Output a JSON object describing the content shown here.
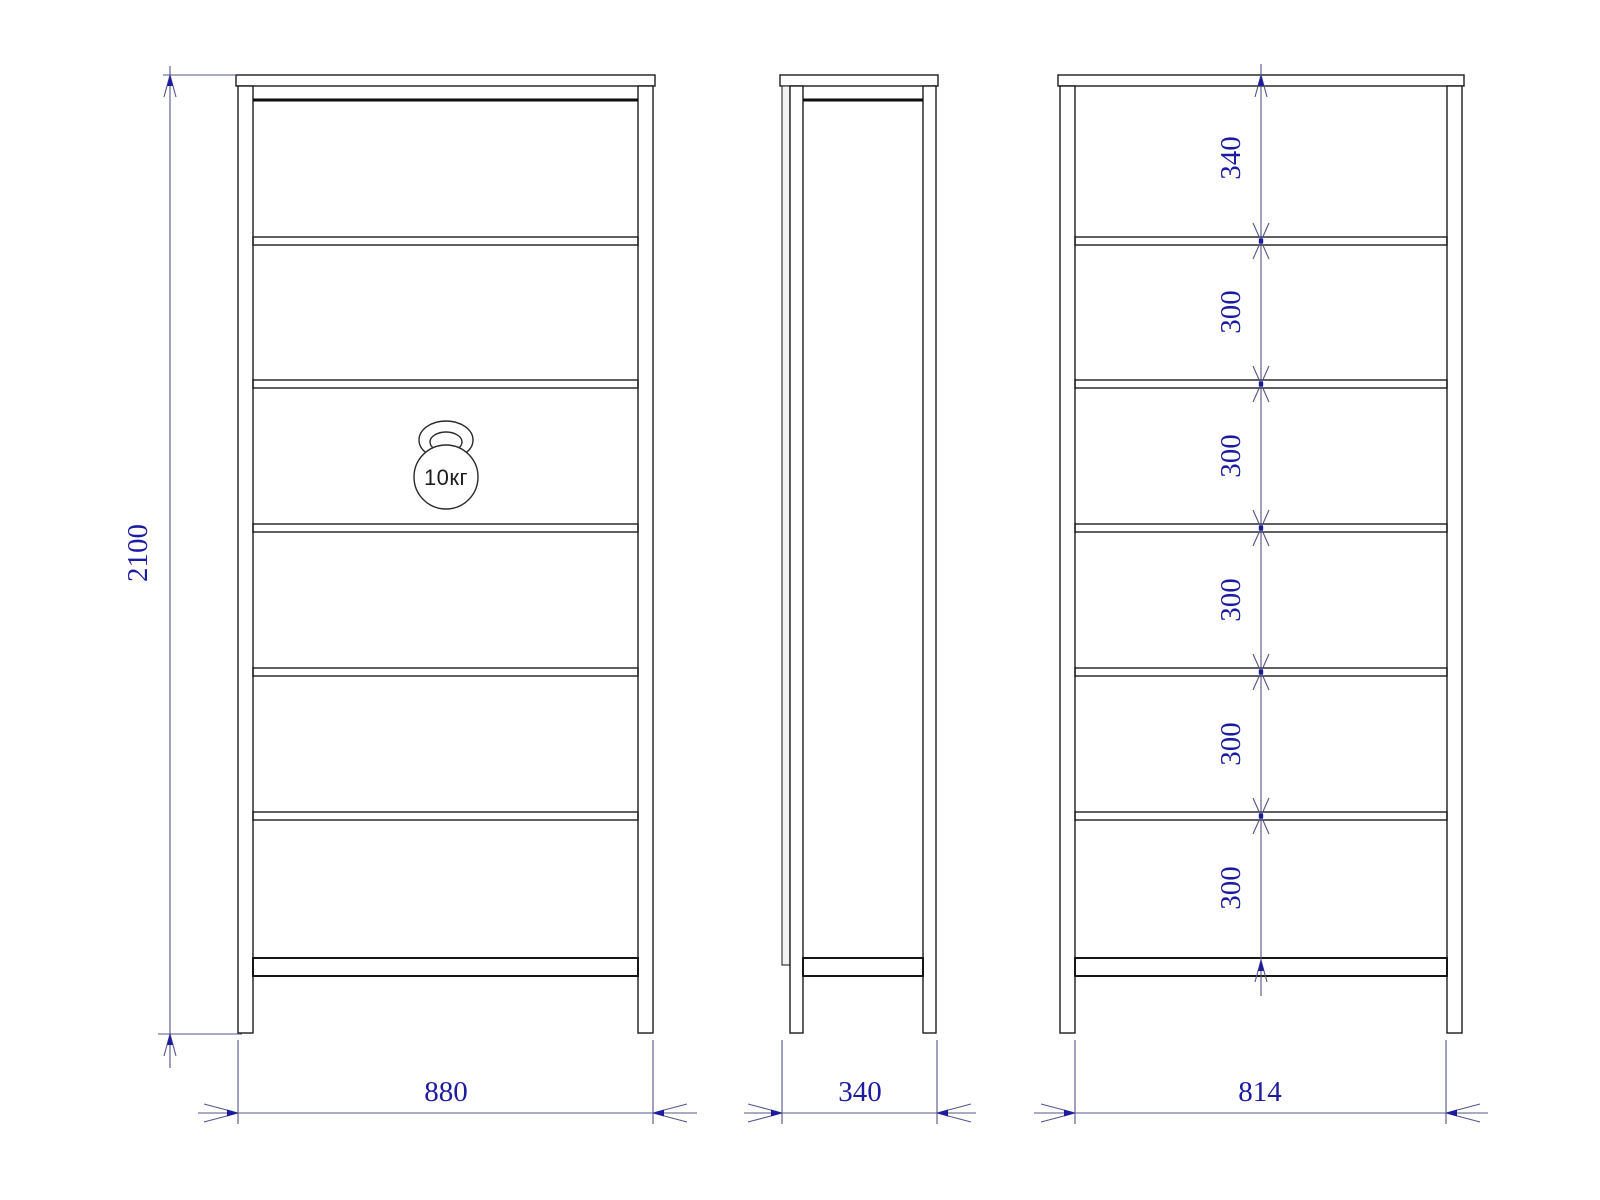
{
  "dimensions": {
    "overall_height": "2100",
    "overall_width": "880",
    "depth": "340",
    "inner_width": "814",
    "shelf_spacing": [
      "340",
      "300",
      "300",
      "300",
      "300",
      "300"
    ]
  },
  "load_badge": {
    "label": "10кг",
    "icon": "kettlebell-icon"
  },
  "colors": {
    "outline": "#1c1c1c",
    "dimension_line": "#54548a",
    "dimension_text": "#1c1ca0",
    "background": "#ffffff"
  }
}
